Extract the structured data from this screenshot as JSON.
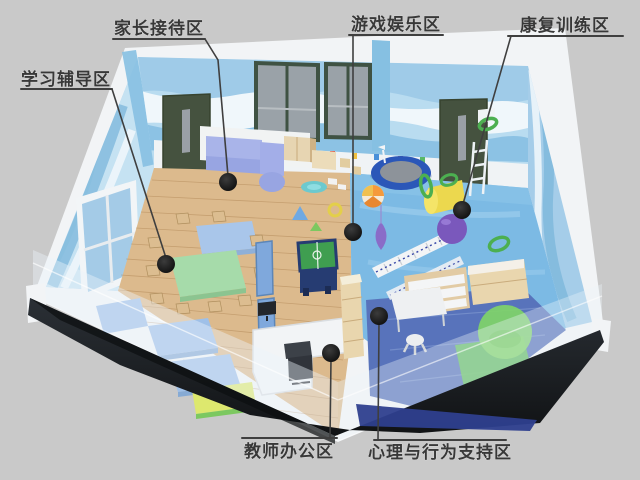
{
  "canvas": {
    "background": "#c9c9c9",
    "kind": "isometric-room-cutaway-rendering"
  },
  "zones": [
    {
      "id": "study",
      "label": "学习辅导区"
    },
    {
      "id": "reception",
      "label": "家长接待区"
    },
    {
      "id": "play",
      "label": "游戏娱乐区"
    },
    {
      "id": "rehab",
      "label": "康复训练区"
    },
    {
      "id": "office",
      "label": "教师办公区"
    },
    {
      "id": "psych",
      "label": "心理与行为支持区"
    }
  ],
  "palette": {
    "background": "#c9c9c9",
    "wall_rim_white": "#f2f4f6",
    "wall_blue": "#b9dcf0",
    "wave_blue": "#7fb9dc",
    "door_green": "#45523f",
    "window_frame_green": "#3f5243",
    "wood_floor": "#dcba8d",
    "play_floor_blue": "#7cbae4",
    "carpet_blue": "#5873bb",
    "sofa_periwinkle": "#a9b4e9",
    "table_green": "#a6dbaa",
    "table_blue": "#a9c6ea",
    "foosball_green": "#3f9e50",
    "foosball_navy": "#263c72",
    "trampoline_blue": "#2b57b8",
    "ball_purple": "#7a58bc",
    "roll_yellow": "#ecd84e",
    "hoop_green": "#4caf50",
    "beanbag_green": "#7fd468",
    "base_dark": "#1c2025",
    "base_navy": "#2e3f8e",
    "callout_line": "#3f3f3f",
    "callout_dot": "#141414",
    "label_text": "#383838"
  }
}
